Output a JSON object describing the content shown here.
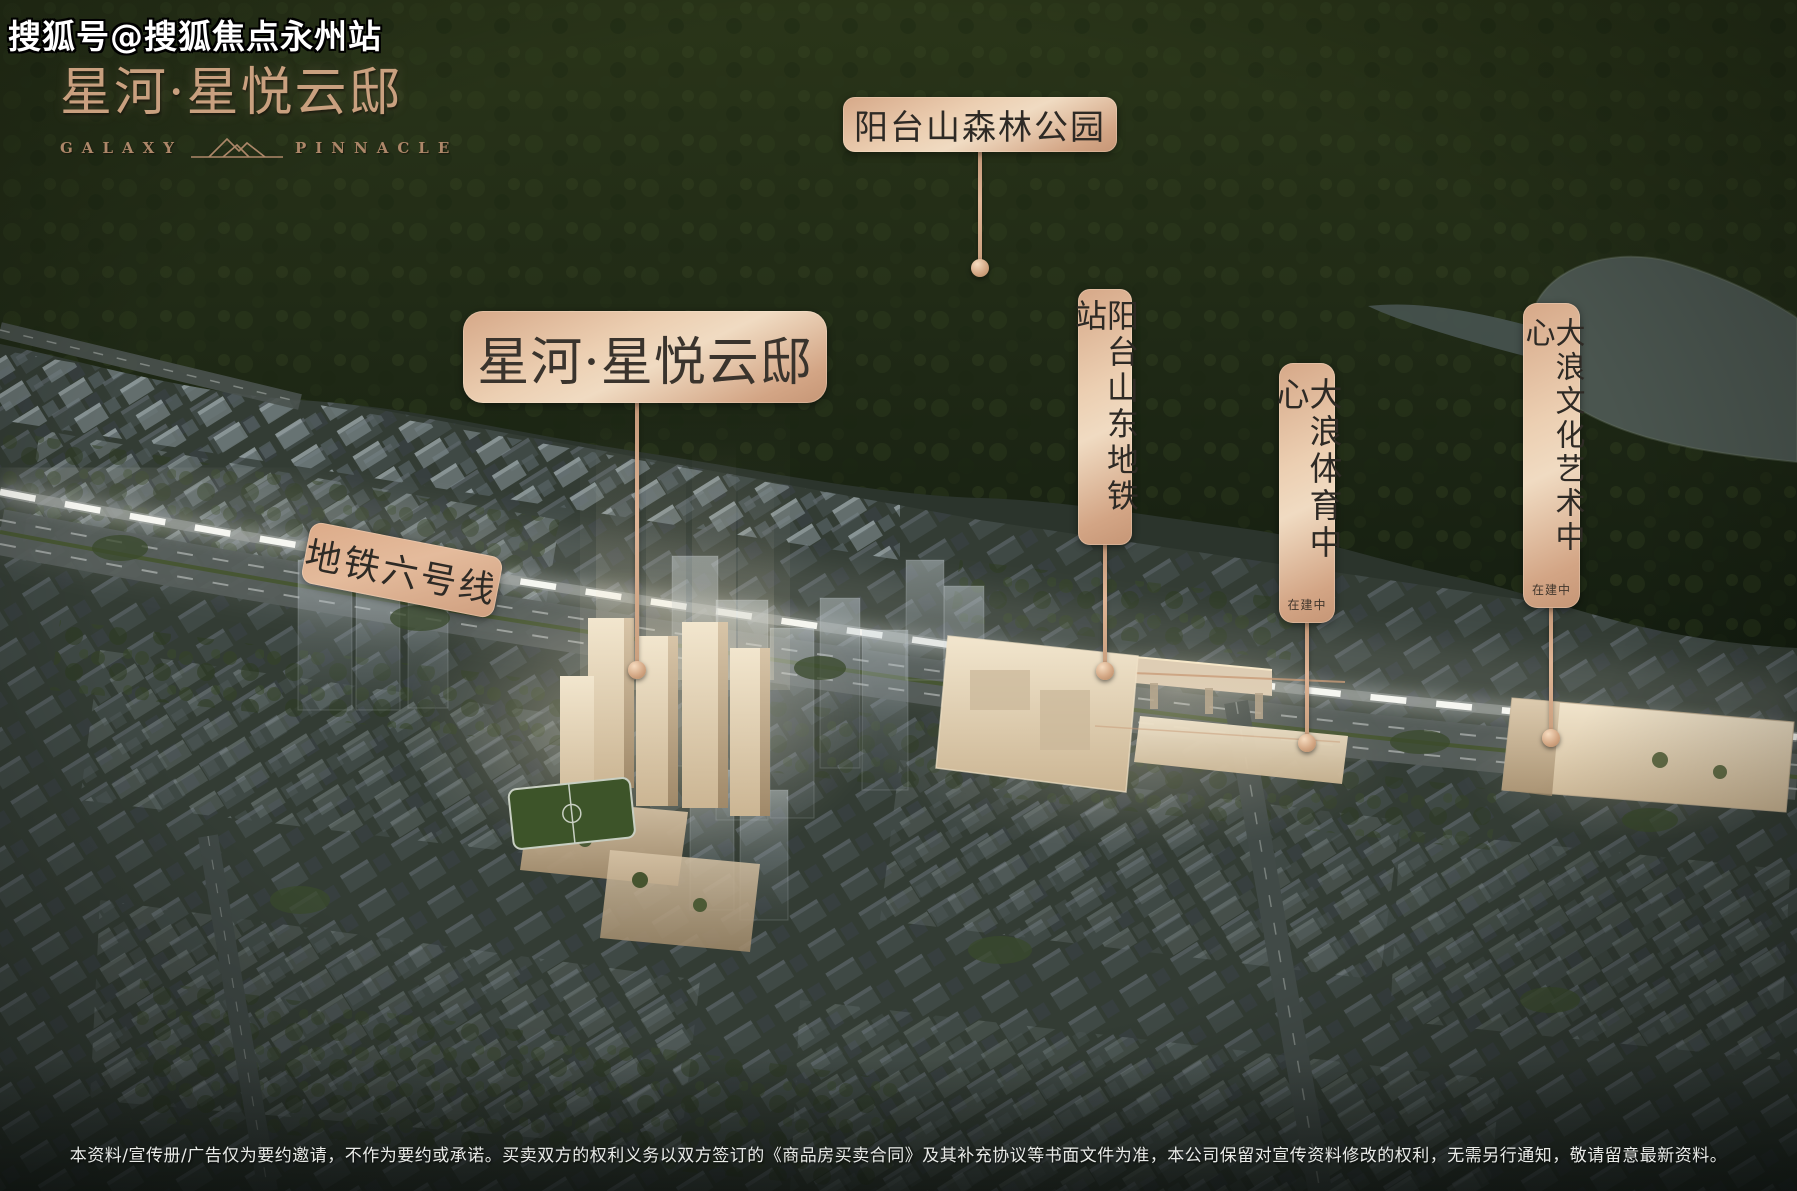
{
  "watermark": {
    "text": "搜狐号@搜狐焦点永州站"
  },
  "logo": {
    "cn": "星河·星悦云邸",
    "en_left": "GALAXY",
    "en_right": "PINNACLE"
  },
  "callouts": {
    "forest_park": {
      "text": "阳台山森林公园"
    },
    "project": {
      "text": "星河·星悦云邸"
    },
    "metro_line": {
      "text": "地铁六号线"
    },
    "metro_station": {
      "text": "阳台山东地铁站"
    },
    "sports_center": {
      "text": "大浪体育中心",
      "status": "在建中"
    },
    "culture_center": {
      "text": "大浪文化艺术中心",
      "status": "在建中"
    }
  },
  "disclaimer": {
    "text": "本资料/宣传册/广告仅为要约邀请，不作为要约或承诺。买卖双方的权利义务以双方签订的《商品房买卖合同》及其补充协议等书面文件为准，本公司保留对宣传资料修改的权利，无需另行通知，敬请留意最新资料。"
  },
  "colors": {
    "copper_accent": "#d0a284",
    "copper_light": "#eed4ba",
    "label_text": "#2e2a25",
    "beige_building": "#e9dcc3",
    "forest_green": "#222c18",
    "watermark_text": "#ffffff"
  }
}
